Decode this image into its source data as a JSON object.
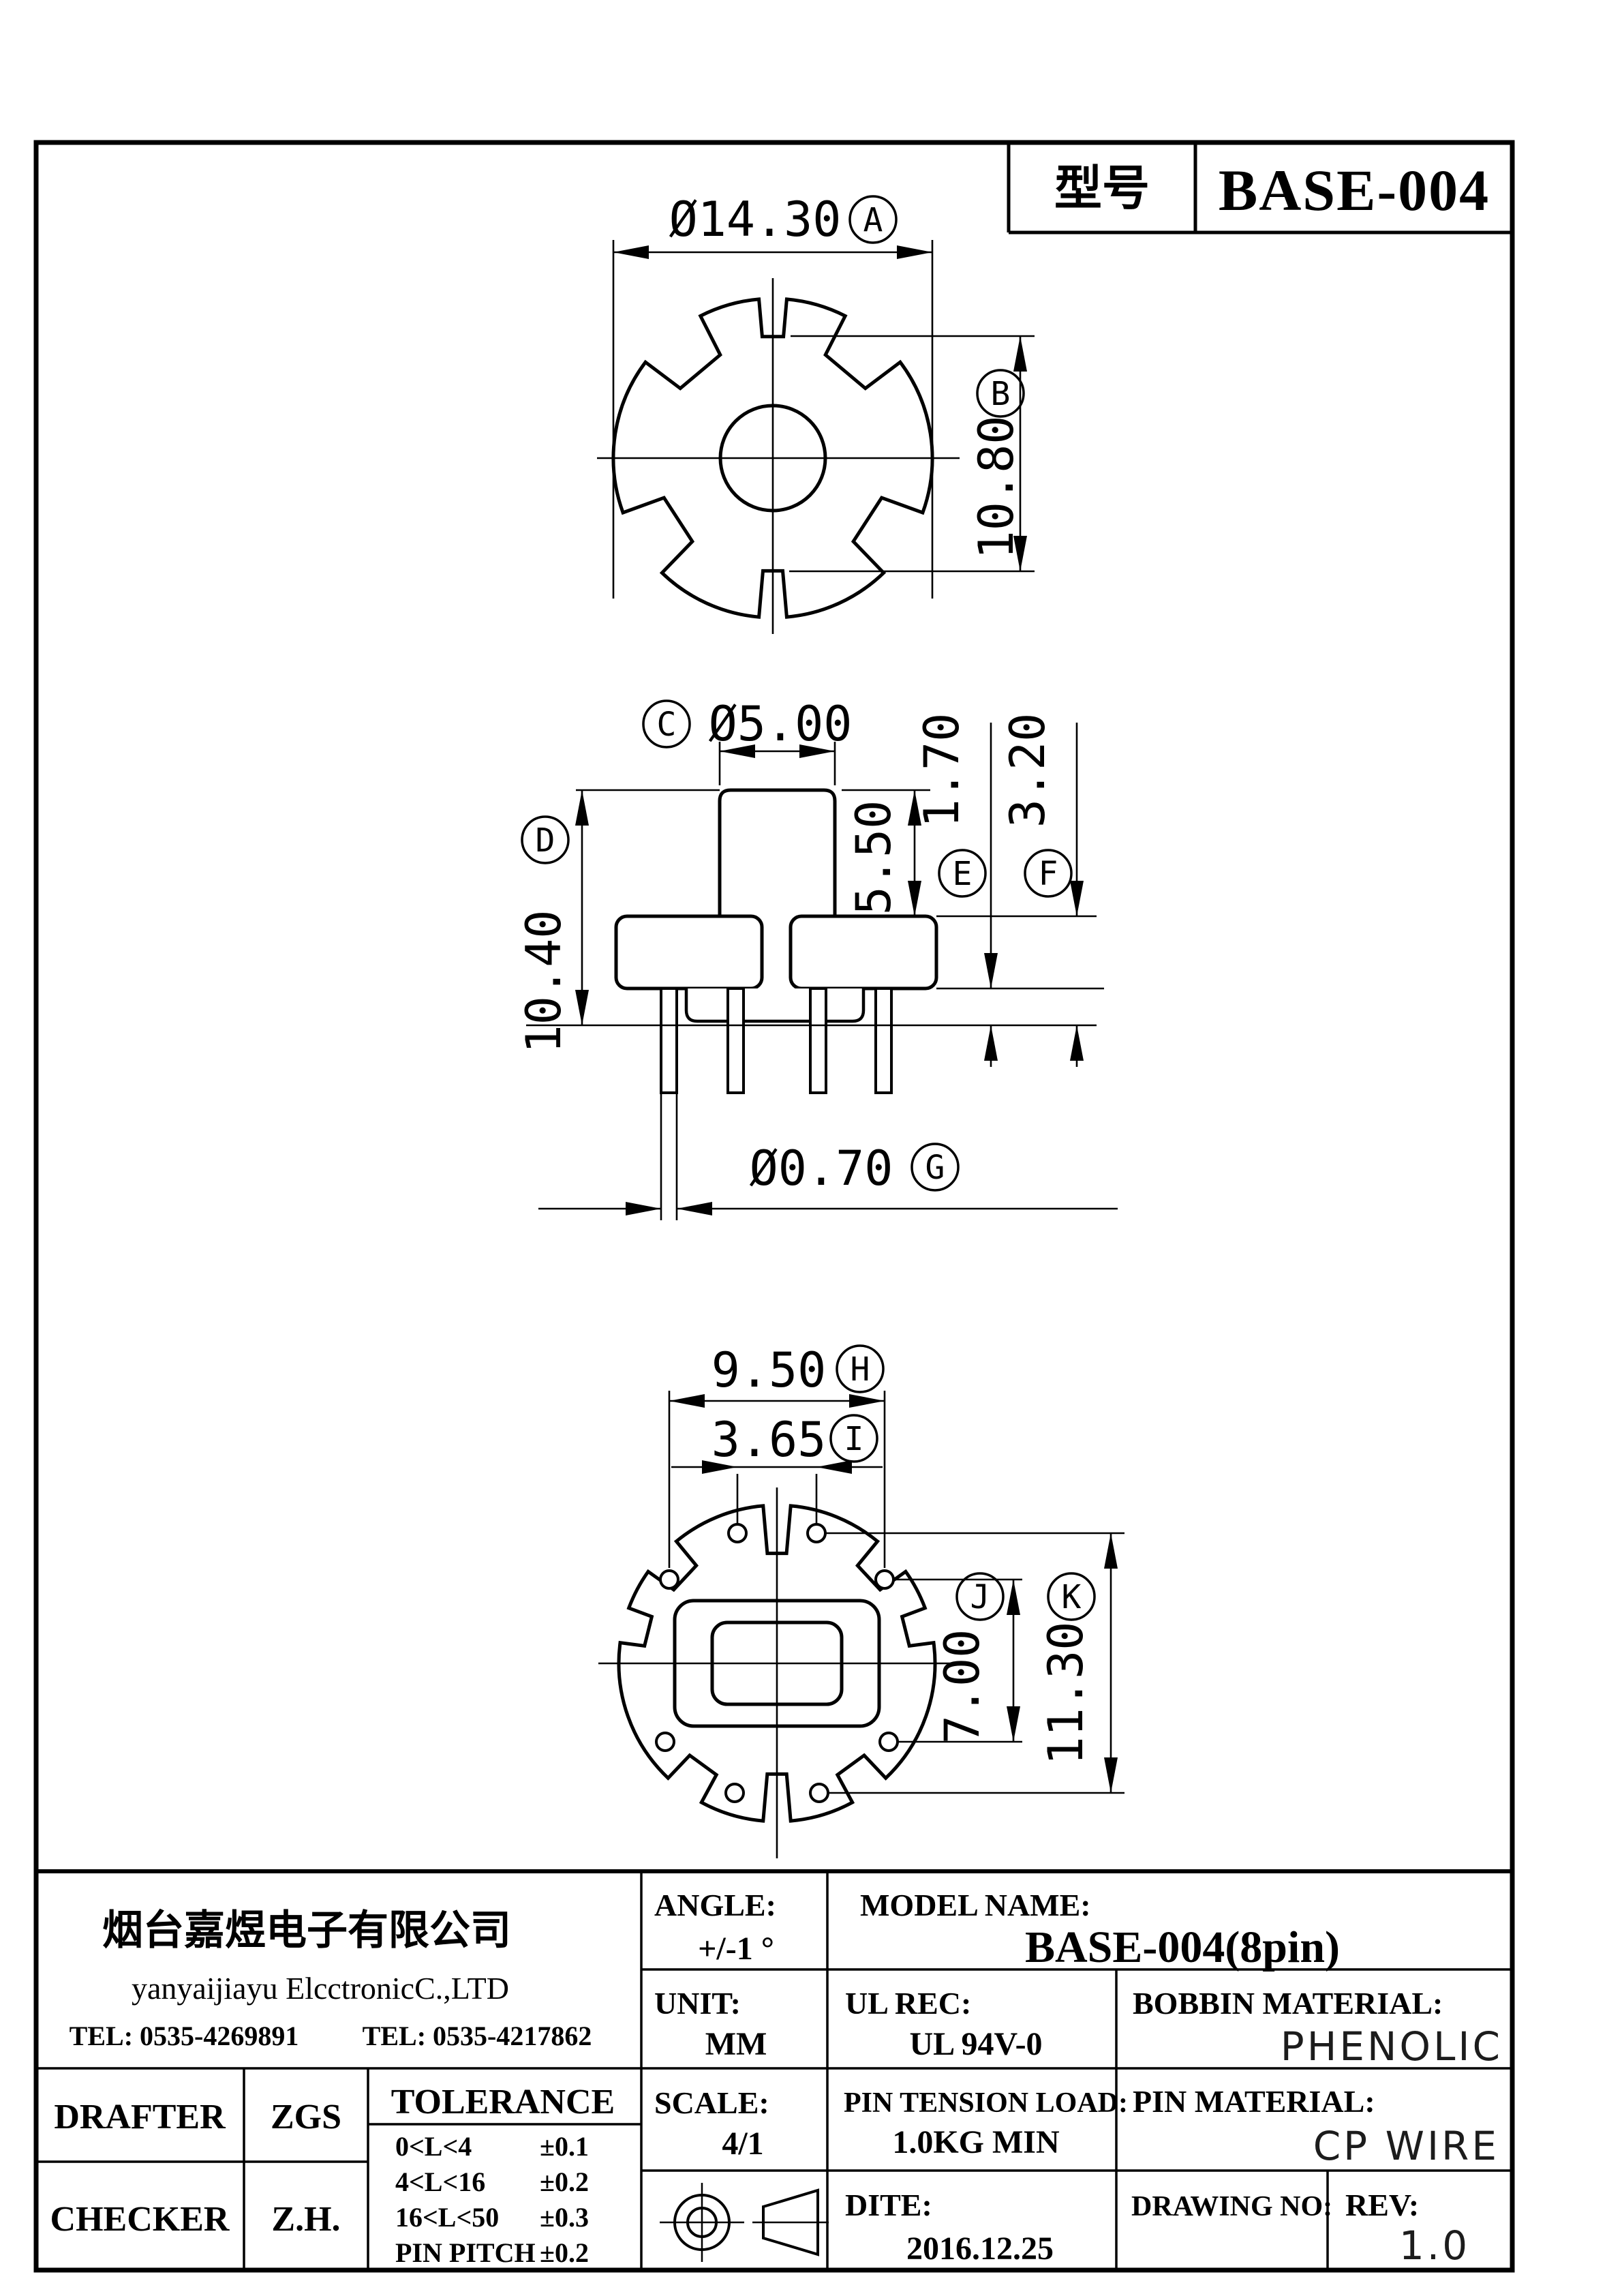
{
  "title_box": {
    "label": "型号",
    "value": "BASE-004"
  },
  "annotations": {
    "A": {
      "letter": "A",
      "text": "Ø14.30"
    },
    "B": {
      "letter": "B",
      "text": "10.80"
    },
    "C": {
      "letter": "C",
      "text": "Ø5.00"
    },
    "D": {
      "letter": "D",
      "text": "10.40"
    },
    "E": {
      "letter": "E",
      "text": "1.70"
    },
    "F": {
      "letter": "F",
      "text": "3.20"
    },
    "G": {
      "letter": "G",
      "text": "Ø0.70"
    },
    "H": {
      "letter": "H",
      "text": "9.50"
    },
    "I": {
      "letter": "I",
      "text": "3.65"
    },
    "J": {
      "letter": "J",
      "text": "7.00"
    },
    "K": {
      "letter": "K",
      "text": "11.30"
    },
    "S550": {
      "text": "5.50"
    }
  },
  "title_block": {
    "company_cn": "烟台嘉煜电子有限公司",
    "company_en": "yanyaijiayu ElcctronicC.,LTD",
    "tel1": "TEL: 0535-4269891",
    "tel2": "TEL: 0535-4217862",
    "angle_label": "ANGLE:",
    "angle_value": "+/-1 °",
    "model_label": "MODEL NAME:",
    "model_value": "BASE-004(8pin)",
    "unit_label": "UNIT:",
    "unit_value": "MM",
    "ul_label": "UL REC:",
    "ul_value": "UL 94V-0",
    "bobbin_label": "BOBBIN MATERIAL:",
    "bobbin_value": "PHENOLIC",
    "scale_label": "SCALE:",
    "scale_value": "4/1",
    "pin_load_label": "PIN TENSION LOAD:",
    "pin_load_value": "1.0KG MIN",
    "pin_mat_label": "PIN MATERIAL:",
    "pin_mat_value": "CP WIRE",
    "dite_label": "DITE:",
    "dite_value": "2016.12.25",
    "drawing_no_label": "DRAWING NO:",
    "rev_label": "REV:",
    "rev_value": "1.0",
    "drafter_label": "DRAFTER",
    "drafter_value": "ZGS",
    "checker_label": "CHECKER",
    "checker_value": "Z.H.",
    "tolerance_title": "TOLERANCE",
    "tolerance_rows": [
      {
        "range": "0<L<4",
        "tol": "±0.1"
      },
      {
        "range": "4<L<16",
        "tol": "±0.2"
      },
      {
        "range": "16<L<50",
        "tol": "±0.3"
      },
      {
        "range": "PIN PITCH",
        "tol": "±0.2"
      }
    ]
  }
}
